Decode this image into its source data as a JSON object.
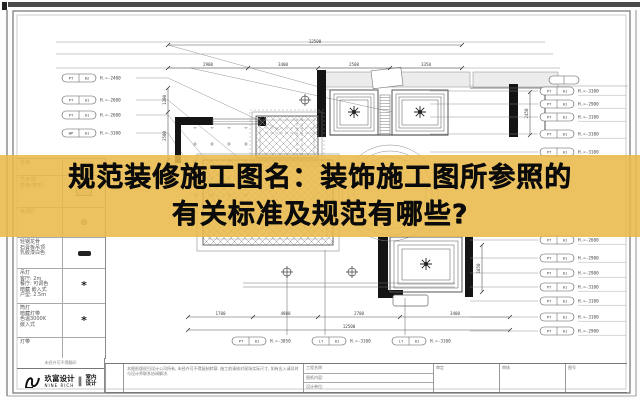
{
  "banner": {
    "line1": "规范装修施工图名：装饰施工图所参照的",
    "line2": "有关标准及规范有哪些?",
    "bg_color": "#E9B949"
  },
  "legend": {
    "header_name": "名称",
    "header_symbol": "图例",
    "rows": [
      {
        "name": "艺术顶/\n壁纸(墙布)",
        "symbol": "material-swatch"
      },
      {
        "name": "吸顶灯",
        "symbol": "ceiling-lamp"
      },
      {
        "name": "轻钢龙骨\n石膏板吊顶\n乳胶漆白色",
        "symbol": "dark-badge"
      },
      {
        "name": "吊灯\n客厅: 2m\n餐厅: 可调色\n暗藏 嵌入式\n户型: 2.5m",
        "symbol": "chandelier"
      },
      {
        "name": "筒灯\n暗藏灯带\n色温3000K\n嵌入式",
        "symbol": "chandelier"
      },
      {
        "name": "灯带",
        "symbol": "none"
      }
    ],
    "footer_note": "未经许可不得翻印"
  },
  "logo": {
    "cn": "玖富设计",
    "en": "NINE RICH",
    "divider": "‖",
    "tag1": "室内",
    "tag2": "设计"
  },
  "titleblock": {
    "notes": "本图纸版权归设计公司所有, 未经许可不得复制转载. 施工前请核对现场实际尺寸, 如有出入请及时与设计师联系协调解决.",
    "fields": [
      {
        "label": "工程名称:"
      },
      {
        "label": "图纸内容:"
      },
      {
        "label": "设计单位:"
      }
    ],
    "cells": [
      {
        "label": "审定"
      },
      {
        "label": "审核"
      },
      {
        "label": "图号"
      }
    ]
  },
  "drawing": {
    "dim_top_total": "12500",
    "dim_top_segments": [
      "2900",
      "3400",
      "2500",
      "3350"
    ],
    "dim_bottom_segments": [
      "1700",
      "4800",
      "2700",
      "3400"
    ],
    "dim_bottom_total": "12500",
    "dim_vertical_left": [
      "1200",
      "2500"
    ],
    "dim_vertical_right": "2450",
    "dim_vertical_mid": "1850",
    "callouts_left": [
      {
        "code": "PT",
        "num": "02",
        "height": "H.=-2400",
        "y": 78
      },
      {
        "code": "PT",
        "num": "01",
        "height": "H.=-2600",
        "y": 100
      },
      {
        "code": "PT",
        "num": "01",
        "height": "H.=-2600",
        "y": 115
      },
      {
        "code": "WP",
        "num": "01",
        "height": "H.=-3100",
        "y": 133
      }
    ],
    "callouts_right": [
      {
        "code": "PT",
        "num": "01",
        "height": "H.=-3100",
        "y": 91
      },
      {
        "code": "PT",
        "num": "01",
        "height": "H.=-2900",
        "y": 104
      },
      {
        "code": "PT",
        "num": "01",
        "height": "H.=-3100",
        "y": 117
      },
      {
        "code": "PT",
        "num": "01",
        "height": "H.=-3100",
        "y": 134
      },
      {
        "code": "PT",
        "num": "01",
        "height": "H.=-3100",
        "y": 152
      },
      {
        "code": "PT",
        "num": "01",
        "height": "H.=-2600",
        "y": 240
      },
      {
        "code": "PT",
        "num": "01",
        "height": "H.=-2900",
        "y": 258
      },
      {
        "code": "PT",
        "num": "01",
        "height": "H.=-2900",
        "y": 273
      },
      {
        "code": "PT",
        "num": "01",
        "height": "H.=-3100",
        "y": 287
      },
      {
        "code": "PT",
        "num": "01",
        "height": "H.=-3100",
        "y": 301
      },
      {
        "code": "PT",
        "num": "01",
        "height": "H.=-3100",
        "y": 317
      },
      {
        "code": "PT",
        "num": "01",
        "height": "H.=-2900",
        "y": 331
      }
    ],
    "callouts_bottom": [
      {
        "code": "PT",
        "num": "01",
        "height": "H.=-3050",
        "x": 232
      },
      {
        "code": "LT",
        "num": "01",
        "height": "H.=-3100",
        "x": 312
      },
      {
        "code": "LT",
        "num": "01",
        "height": "H.=-3100",
        "x": 392
      }
    ]
  }
}
